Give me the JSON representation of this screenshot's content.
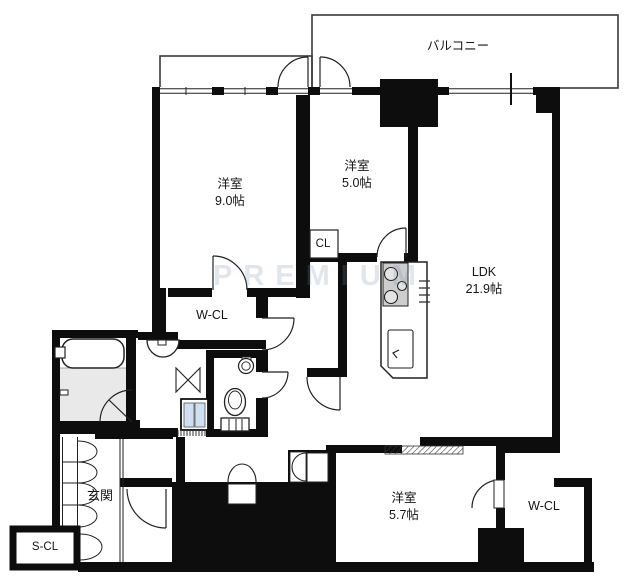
{
  "floor_plan": {
    "balcony": {
      "label": "バルコニー"
    },
    "rooms": {
      "bedroom_main": {
        "name": "洋室",
        "size": "9.0帖"
      },
      "bedroom_small": {
        "name": "洋室",
        "size": "5.0帖"
      },
      "ldk": {
        "name": "LDK",
        "size": "21.9帖"
      },
      "bedroom_third": {
        "name": "洋室",
        "size": "5.7帖"
      },
      "closet": {
        "label": "CL"
      },
      "walkin_closet_upper": {
        "label": "W-CL"
      },
      "walkin_closet_lower": {
        "label": "W-CL"
      },
      "entrance": {
        "label": "玄関"
      },
      "shoe_closet": {
        "label": "S-CL"
      }
    },
    "watermark": "PREMIUM",
    "colors": {
      "wall": "#0d0d0d",
      "balcony_outline": "#3a3a3a",
      "bath_floor": "#e9e9e9",
      "stove_gray": "#cdcdcd",
      "washer_blue": "#cfe0f2"
    }
  }
}
